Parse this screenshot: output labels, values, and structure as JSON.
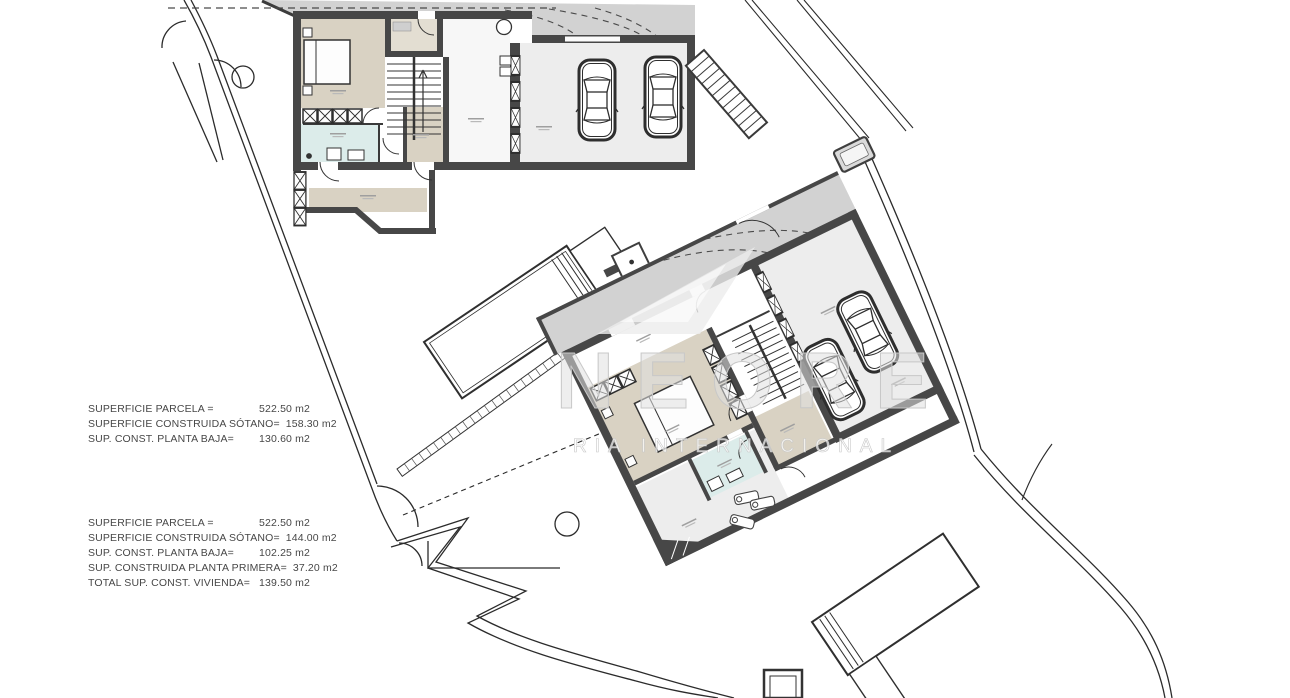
{
  "watermark": {
    "brand_letters": "NEORE",
    "tagline": "RIA INTERNACIONAL"
  },
  "area_tables": {
    "block1": {
      "rows": [
        {
          "label": "SUPERFICIE PARCELA =",
          "value": "522.50 m2"
        },
        {
          "label": "SUPERFICIE CONSTRUIDA SÓTANO=",
          "value": "158.30 m2"
        },
        {
          "label": "SUP. CONST. PLANTA BAJA=",
          "value": "130.60 m2"
        }
      ]
    },
    "block2": {
      "rows": [
        {
          "label": "SUPERFICIE PARCELA =",
          "value": "522.50 m2"
        },
        {
          "label": "SUPERFICIE CONSTRUIDA SÓTANO=",
          "value": "144.00 m2"
        },
        {
          "label": "SUP. CONST. PLANTA BAJA=",
          "value": "102.25 m2"
        },
        {
          "label": "SUP. CONSTRUIDA PLANTA PRIMERA=",
          "value": "37.20 m2"
        },
        {
          "label": "TOTAL SUP. CONST. VIVIENDA=",
          "value": "139.50 m2"
        }
      ]
    }
  },
  "palette": {
    "wall": "#474747",
    "room_beige": "#d9d2c3",
    "room_bath": "#dcecea",
    "room_gray": "#ededed",
    "driveway_gray": "#d2d2d2",
    "line": "#2b2b2b",
    "watermark_gray": "#d9d9d9"
  }
}
